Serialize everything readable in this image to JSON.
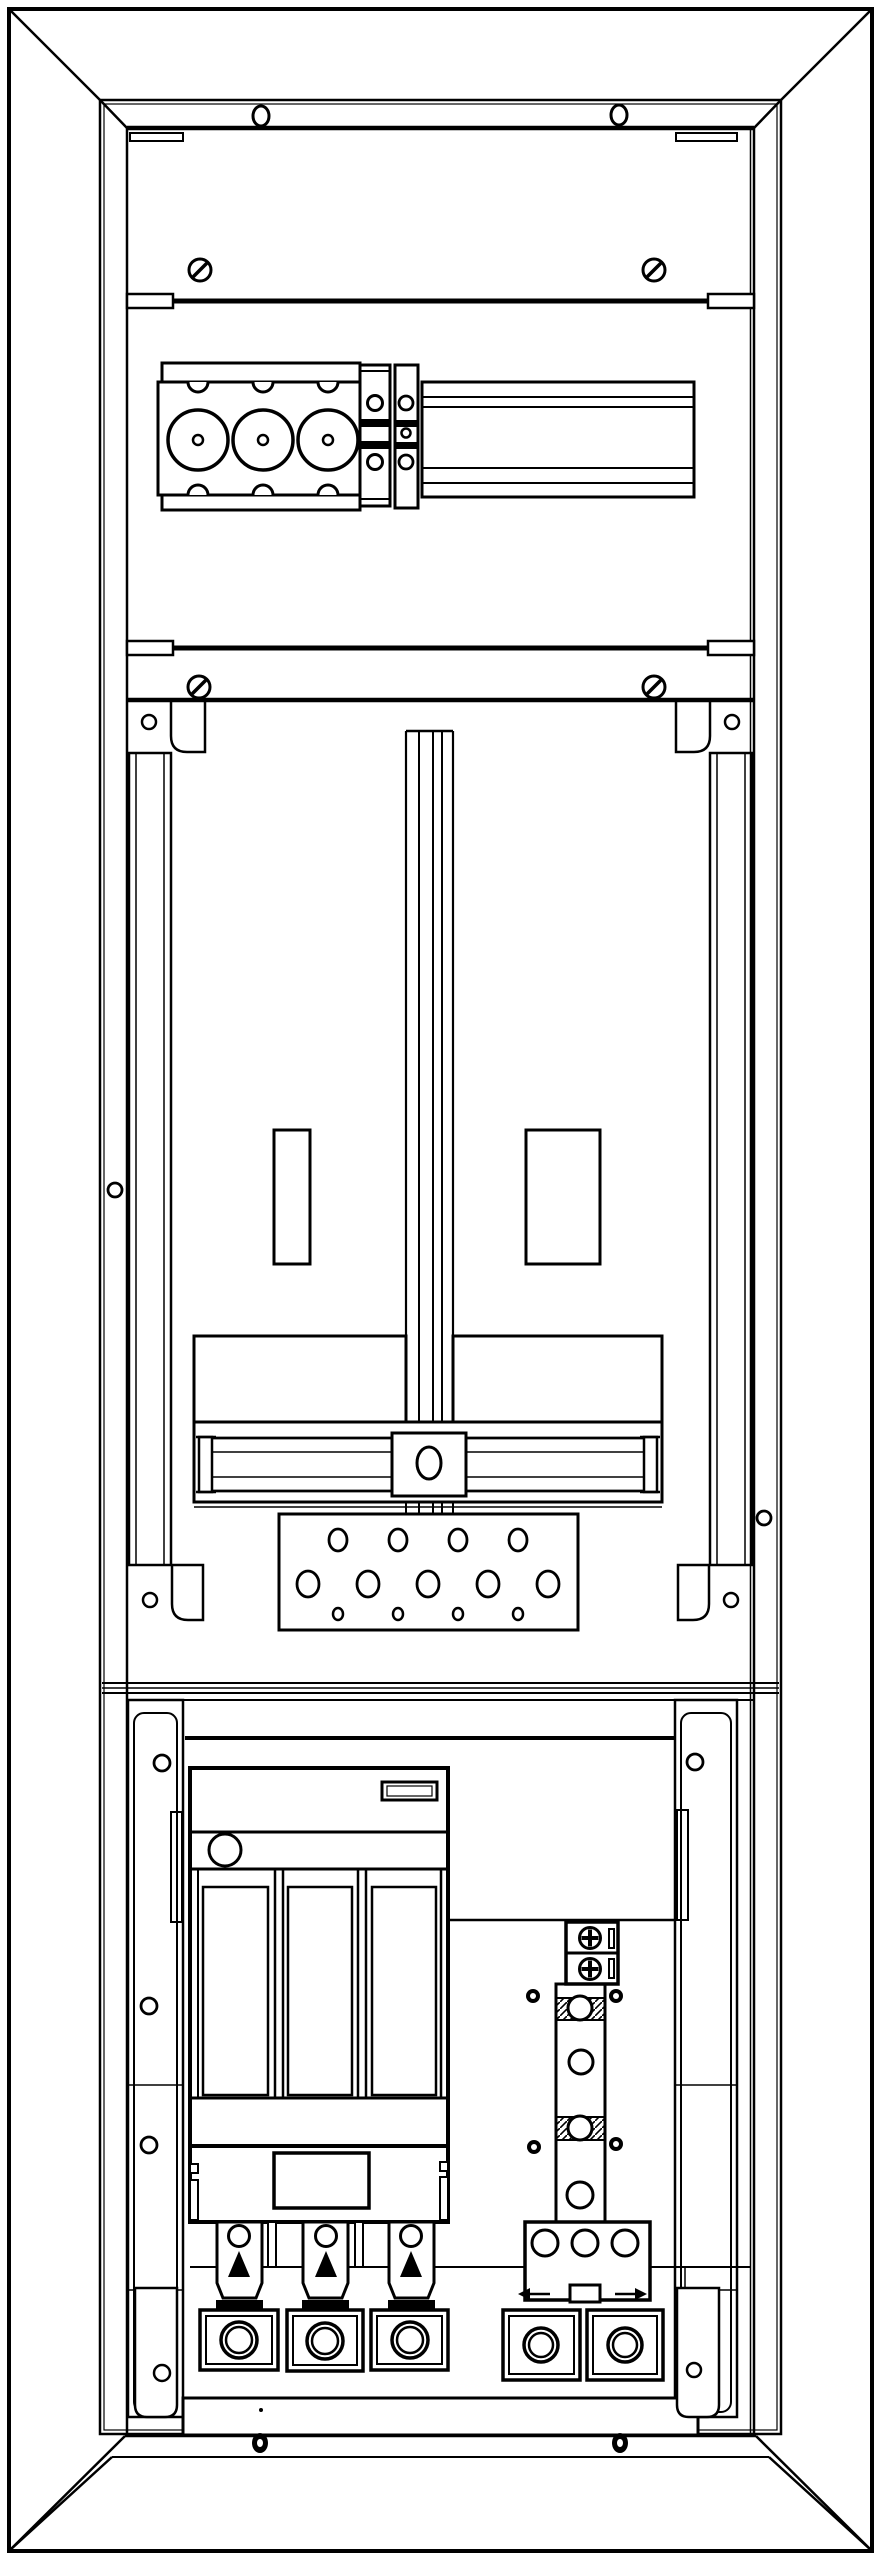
{
  "document": {
    "type": "technical-line-drawing",
    "subject": "Meter cabinet enclosure – front view line drawing",
    "background_color": "#ffffff",
    "line_color": "#000000",
    "text_items": []
  },
  "enclosure": {
    "outer_frame": "beveled cabinet frame",
    "top_face_holes": 2,
    "bottom_face_screws": 2,
    "side_hole_left": 1,
    "side_hole_right": 1
  },
  "top_section": {
    "slotted_screws": 4,
    "divider_rails": 2,
    "busbar_block": {
      "poles": 3,
      "large_circles": 3,
      "notches_top": 3,
      "notches_bottom": 3
    },
    "connector_columns": 2,
    "din_rail": {
      "horizontal_lines": 4
    }
  },
  "middle_section": {
    "corner_brackets": 4,
    "bracket_holes": 4,
    "vertical_rails": 2,
    "center_meter_rail": 1,
    "windows": [
      {
        "side": "left"
      },
      {
        "side": "right"
      }
    ],
    "mounting_plates": 2,
    "sliding_crossbar": {
      "center_block_hole": 1,
      "end_stops": 2
    },
    "perforated_gland_plate": {
      "row1_holes": 4,
      "row2_holes": 5,
      "row3_holes": 4
    }
  },
  "bottom_section": {
    "uprights": 2,
    "upright_holes_left": 4,
    "upright_holes_right": 2,
    "nh_fuse_switch": {
      "label_windows": 2,
      "knob": 1,
      "fuse_carriers": 3,
      "pull_handles": 3,
      "handle_triangles": 3
    },
    "n_pe_busbar": {
      "phillips_screws": 2,
      "clamp_zones": 2,
      "bar_holes": 3,
      "bottom_block_holes": 3,
      "arrow_marks": 2
    },
    "phase_terminals": 3,
    "neutral_terminals": 2,
    "bottom_rail_dot": 1
  },
  "icons": [
    "slotted-screw-icon",
    "phillips-screw-icon",
    "washer-screw-icon",
    "fuse-pull-handle-icon",
    "arrow-mark-icon",
    "terminal-ring-icon"
  ]
}
